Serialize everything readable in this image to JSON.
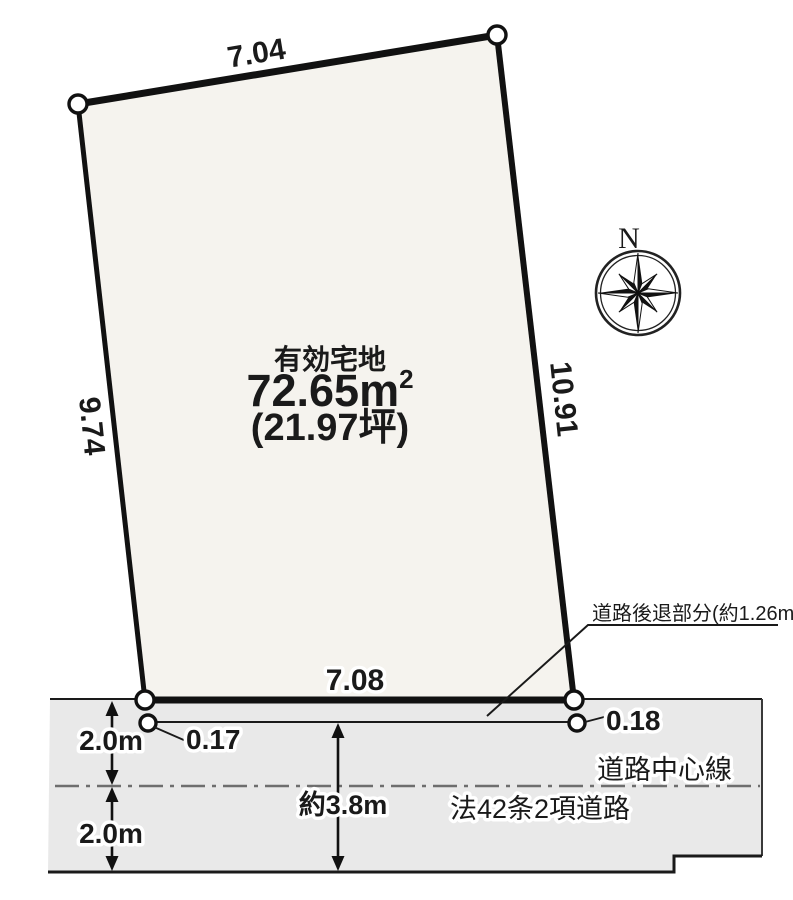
{
  "plot": {
    "title": "有効宅地",
    "area_main": "72.65m",
    "area_sup": "2",
    "area_tsubo": "(21.97坪)",
    "dimensions": {
      "top": "7.04",
      "left": "9.74",
      "right": "10.91",
      "bottom": "7.08"
    }
  },
  "setback": {
    "label_main": "道路後退部分(約1.26m",
    "label_sup": "2",
    "label_close": ")",
    "left_offset": "0.17",
    "right_offset": "0.18"
  },
  "road": {
    "upper_width": "2.0m",
    "lower_width": "2.0m",
    "total_width": "約3.8m",
    "centerline_label": "道路中心線",
    "type_label": "法42条2項道路"
  },
  "compass": {
    "north": "N"
  },
  "colors": {
    "plot_fill": "#f5f3ee",
    "road_fill": "#e9e9e9",
    "line": "#1a1a1a",
    "centerline_gray": "#6e6e6e"
  }
}
